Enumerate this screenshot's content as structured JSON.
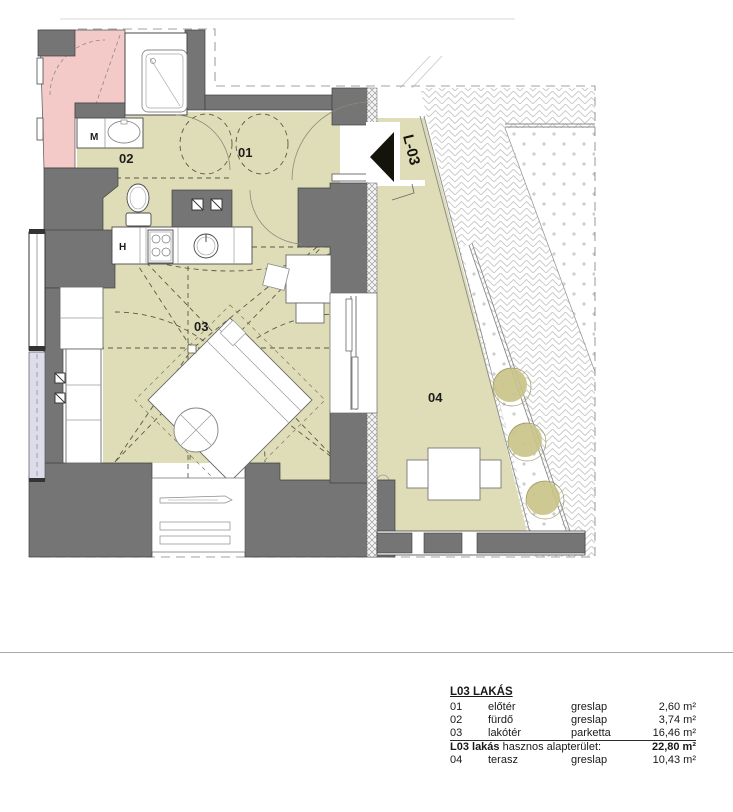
{
  "plan": {
    "labels": {
      "room01": "01",
      "room02": "02",
      "room03": "03",
      "room04": "04",
      "washbasin": "M",
      "appliance": "H",
      "entry_door": "L-03"
    },
    "colors": {
      "wall": "#757575",
      "floor": "#dfddb8",
      "neighbor_unit": "#f4cac8",
      "terrace_plant": "#c9c386",
      "entry_arrow": "#14140c",
      "window_strip": "#dcdcea"
    }
  },
  "legend": {
    "title": "L03 LAKÁS",
    "rows": [
      {
        "num": "01",
        "name": "előtér",
        "material": "greslap",
        "area": "2,60 m²"
      },
      {
        "num": "02",
        "name": "fürdő",
        "material": "greslap",
        "area": "3,74 m²"
      },
      {
        "num": "03",
        "name": "lakótér",
        "material": "parketta",
        "area": "16,46 m²"
      }
    ],
    "total": {
      "label_bold": "L03 lakás",
      "label_rest": "hasznos alapterület:",
      "value": "22,80 m²"
    },
    "extra": {
      "num": "04",
      "name": "terasz",
      "material": "greslap",
      "area": "10,43 m²"
    }
  }
}
